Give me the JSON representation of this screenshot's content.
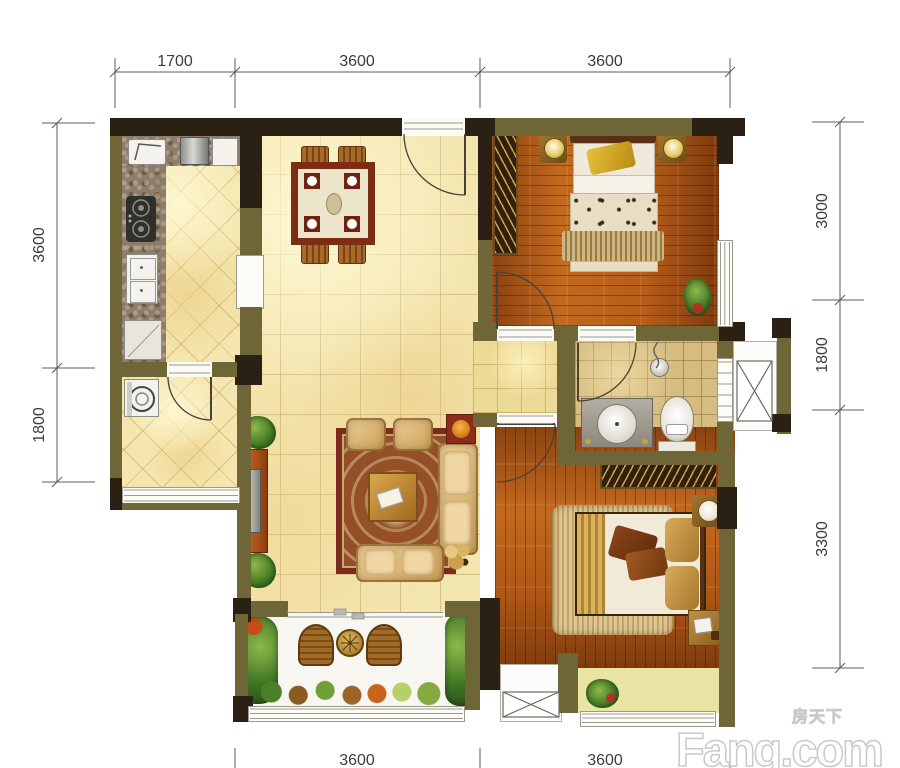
{
  "dimensions": {
    "top": [
      "1700",
      "3600",
      "3600"
    ],
    "left": [
      "3600",
      "1800"
    ],
    "right": [
      "3000",
      "1800",
      "3300"
    ],
    "bottom": [
      "3600",
      "3600"
    ]
  },
  "watermark": {
    "brand": "Fang.com",
    "cjk": "房天下"
  },
  "colors": {
    "wall_olive": "#6e6637",
    "wall_dark": "#2a2014",
    "tile_floor": "#f3e5ae",
    "hall_floor": "#eeda97",
    "wood_floor": "#b55d1a",
    "bath_tile": "#d7bc82",
    "bay_floor": "#eae4a4",
    "rug_border": "#7c2a20",
    "dim_text": "#3c3c3c"
  }
}
